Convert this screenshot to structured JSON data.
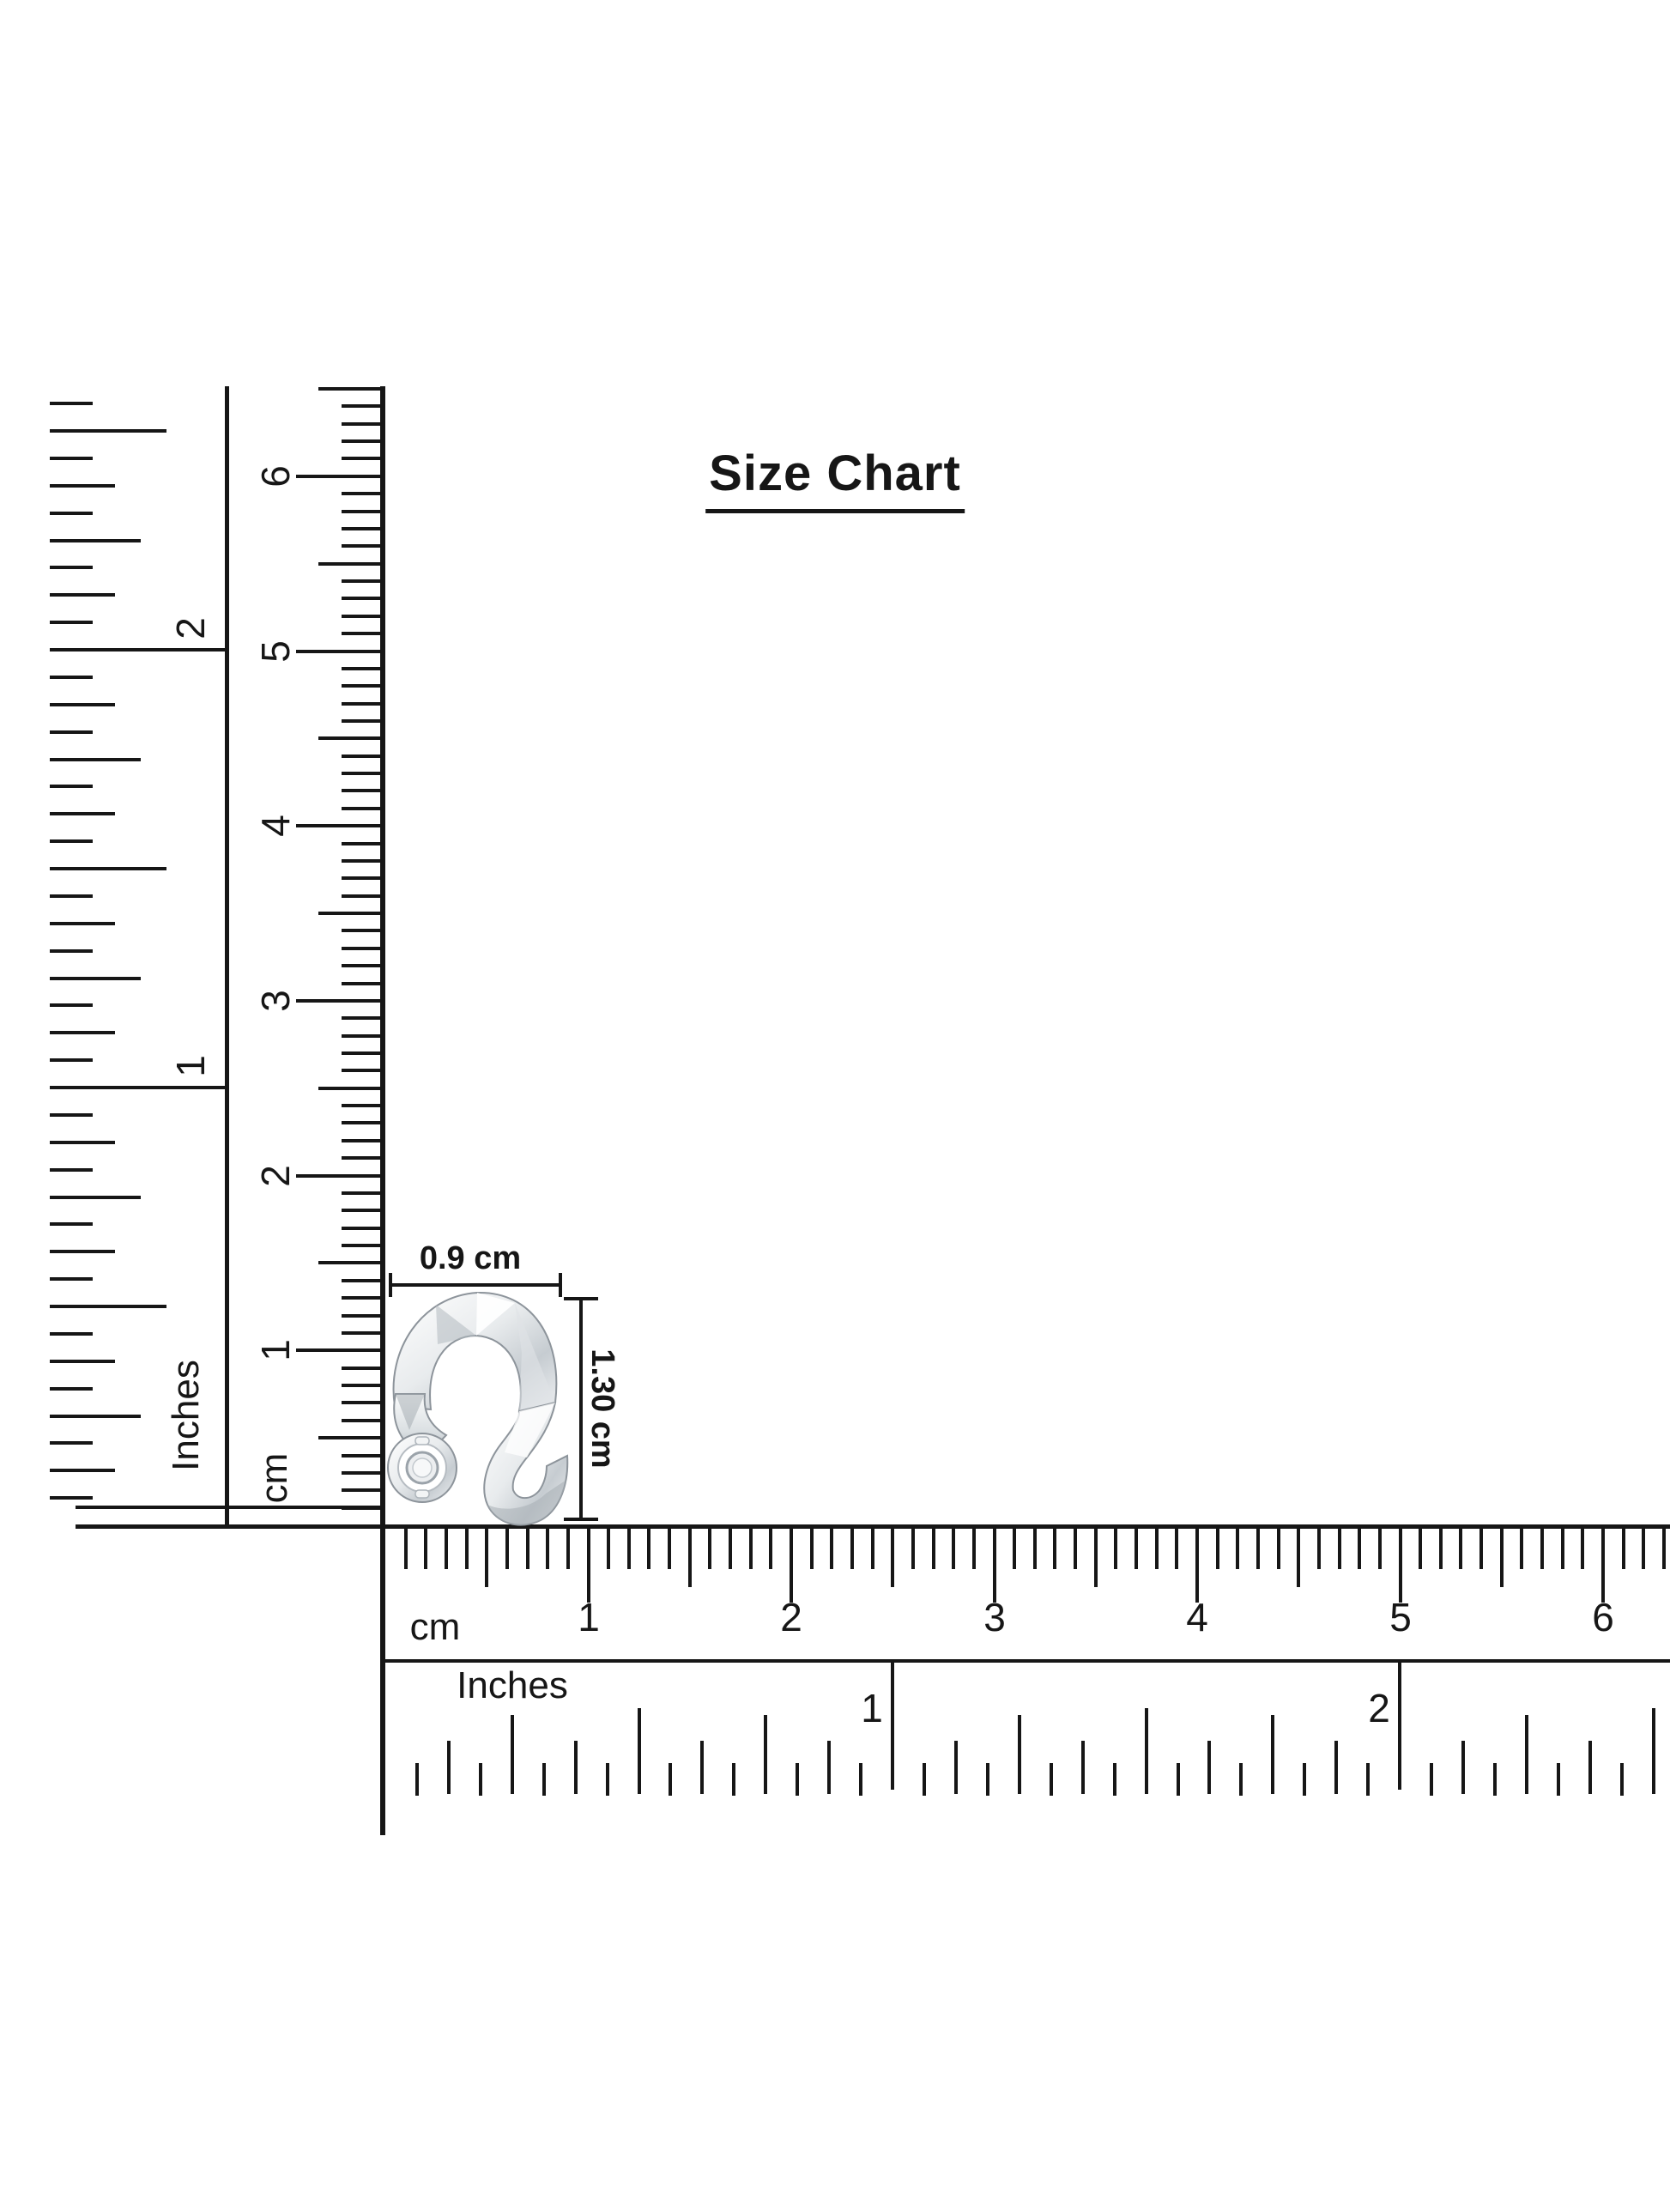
{
  "title": {
    "text": "Size Chart"
  },
  "product": {
    "label": "silver twisted ear cuff with round bezel",
    "width_dimension": "0.9 cm",
    "height_dimension": "1.30 cm"
  },
  "rulers": {
    "vertical_inches": {
      "unit": "Inches",
      "labels": [
        "1",
        "2"
      ]
    },
    "vertical_cm": {
      "unit": "cm",
      "labels": [
        "1",
        "2",
        "3",
        "4",
        "5",
        "6"
      ]
    },
    "horizontal_cm": {
      "unit": "cm",
      "labels": [
        "1",
        "2",
        "3",
        "4",
        "5",
        "6"
      ]
    },
    "horizontal_inches": {
      "unit": "Inches",
      "labels": [
        "1",
        "2"
      ]
    }
  },
  "colors": {
    "ink": "#161616",
    "background": "#ffffff",
    "silver_light": "#f7f8f9",
    "silver_mid": "#c9ced3",
    "silver_dark": "#9aa2a9"
  }
}
